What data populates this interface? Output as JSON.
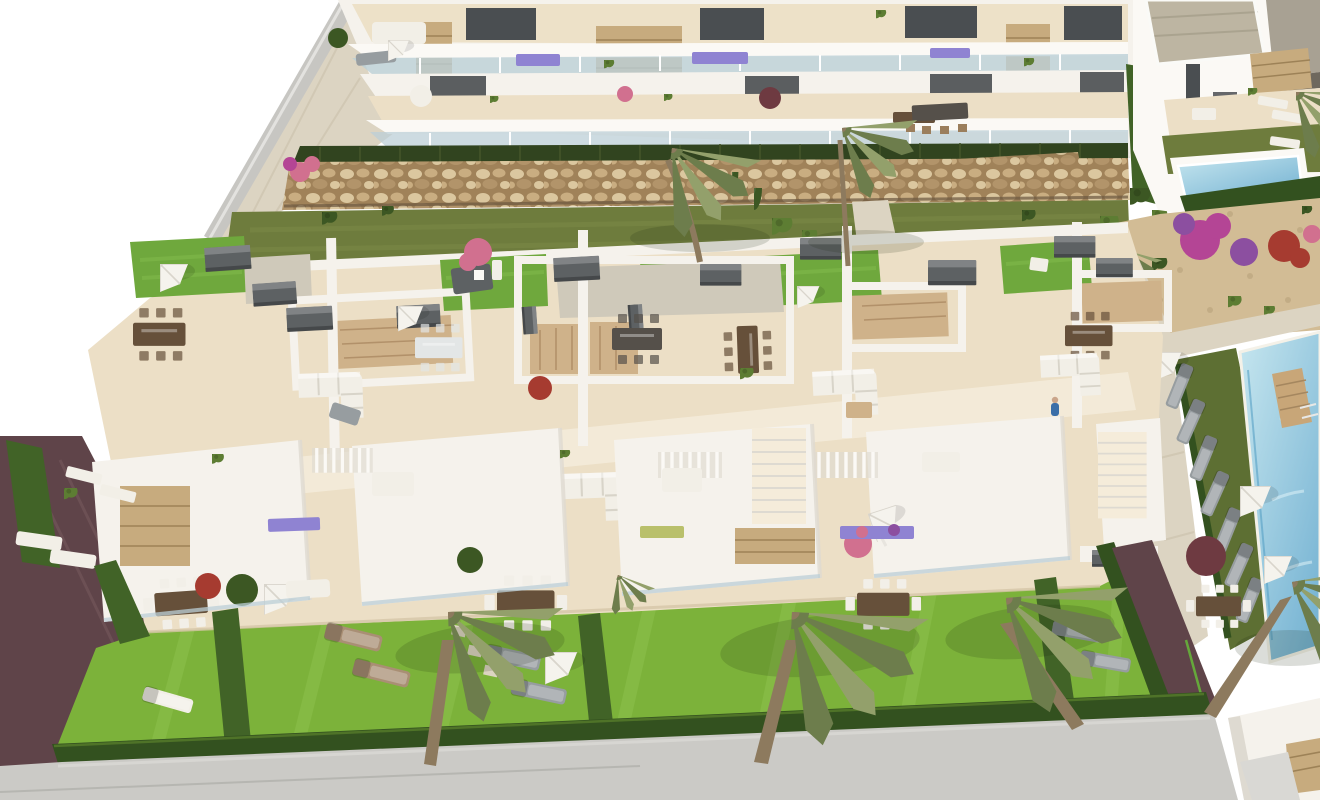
{
  "meta": {
    "title": "Aerial 3D render of a residential development",
    "description": "Photorealistic aerial 3D architectural rendering of a modern white residential complex: a two-storey apartment block with balconies at the top, a gabion stone retaining wall, a long row of townhouses with furnished roof terraces, private lawned gardens with hedges and palm trees at the bottom, a communal swimming pool with sun loungers and parasols on the right, and detached villas with a private pool in the top right corner. No text, labels or UI elements are visible.",
    "image_size": "1320x800"
  },
  "palette": {
    "bg": "#ffffff",
    "street": "#cbcac6",
    "streetLight": "#d9d8d4",
    "curb": "#a9a8a3",
    "soil": "#4d3f35",
    "pathMaroon": "#5f4449",
    "pathMaroonLight": "#7a5c60",
    "hedgeDark": "#33511f",
    "hedgeMid": "#416327",
    "hedgeLight": "#66b43a",
    "lawnBright": "#7cb23a",
    "lawnBrightLight": "#93c654",
    "lawnOlive": "#6e7c3d",
    "lawnOliveLight": "#7e8c49",
    "lawnPool": "#5d6f33",
    "roofLawn": "#6fa83d",
    "roofLawnLight": "#83bc4e",
    "reed": "#31441f",
    "gabionBase": "#a08259",
    "gabionA": "#dbc79f",
    "gabionB": "#c9ad81",
    "gabionC": "#b2946a",
    "stoneClad": "#c7ab7e",
    "stoneDark": "#9d8257",
    "walk": "#dcd4c2",
    "walkTile": "#c9c0aa",
    "floorCream": "#ecdfc6",
    "floorLight": "#f5ecda",
    "floorShadow": "#d6c6a8",
    "wall": "#f5f2ec",
    "wallBright": "#fbf9f5",
    "wallShadow": "#dedad1",
    "wallGray": "#c7c6c2",
    "opening": "#4a4e51",
    "glass": "#bccfd7",
    "boxGray": "#5d6163",
    "wood": "#cfb28a",
    "woodDark": "#b2916a",
    "tableBrown": "#66503a",
    "tableDark": "#55504a",
    "chairTan": "#9b7e5c",
    "sofa": "#f2efe7",
    "cushion": "#e3e6e6",
    "sofaShadow": "#d8d4c9",
    "umbrella": "#f5f3ed",
    "umbrellaShade": "#d9d5cc",
    "loungerGray": "#979da0",
    "loungerBronze": "#a98f74",
    "poolLight": "#c6e6ef",
    "poolDeep": "#74b2d2",
    "poolEdge": "#57a0c4",
    "deckWood": "#c8a678",
    "villaRoofA": "#bdb5a2",
    "villaRoofB": "#a8a193",
    "eave": "#6e685e",
    "gravel": "#d2bc95",
    "gravelLight": "#cfc9ba",
    "gravelDark": "#b59f79",
    "plantGreen": "#5d7d33",
    "plantDark": "#3c5723",
    "palmLight": "#93a06b",
    "palmDark": "#6d7d4c",
    "trunk": "#8d7a5e",
    "flowerMagenta": "#b44595",
    "flowerPurple": "#8c4fa0",
    "flowerRed": "#a63b30",
    "flowerMaroon": "#6e3a41",
    "flowerLavender": "#8f83d2",
    "flowerPink": "#d1708f",
    "flowerYellow": "#b9c06b"
  },
  "scene": {
    "regions": [
      {
        "id": "apartment-block",
        "label": "Two-storey white apartment block with glass-railed balconies, stone-clad piers and terrace furniture"
      },
      {
        "id": "gabion-wall",
        "label": "Gabion stone retaining wall with reed planting strip above the communal lawn"
      },
      {
        "id": "communal-lawn-strip",
        "label": "Olive-green lawn strip with palm trees, cypresses and shrubs"
      },
      {
        "id": "townhouse-block",
        "label": "Row of townhouses with roof-lawn patches, furnished roof terraces, stairwell courtyards and ground-floor dining terraces"
      },
      {
        "id": "private-gardens",
        "label": "Bright lawned private gardens divided by dark hedges, with sun loungers and parasols"
      },
      {
        "id": "pool-area",
        "label": "Communal swimming pool with wooden deck bridge, lounger row, parasols and gravel garden with flowering shrubs"
      },
      {
        "id": "villas-top-right",
        "label": "Detached villas with flat roofs, terrace, lawn and small private pool"
      },
      {
        "id": "street",
        "label": "Perimeter hedge, dark red-brown side paths and light grey street along the bottom"
      },
      {
        "id": "entrance-gate",
        "label": "White entrance gate structure with stone-clad pillar at bottom right"
      }
    ],
    "counts": {
      "townhouse_units_visible": 5,
      "apartment_floors": 2,
      "roof_lawn_patches": 5,
      "palm_trees_large": 7,
      "palm_trees_small": 2,
      "white_parasols": 11,
      "sun_loungers": 22,
      "dining_sets": 8,
      "corner_sofas": 4,
      "swimming_pools": 2,
      "gray_storage_boxes": 12,
      "people": 1
    }
  }
}
